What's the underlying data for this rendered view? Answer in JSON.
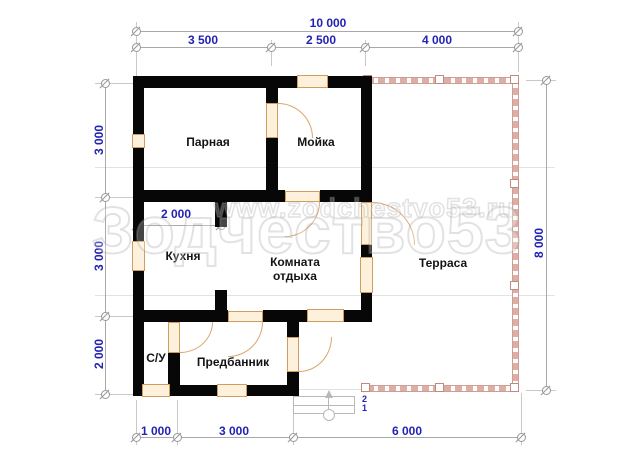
{
  "drawing": {
    "type": "bathhouse floor plan",
    "watermark": {
      "title": "Зодчество53",
      "url": "www.zodchestvo53.ru"
    },
    "rooms": {
      "parnaya": "Парная",
      "moyka": "Мойка",
      "kuhnya": "Кухня",
      "komnata_line1": "Комната",
      "komnata_line2": "отдыха",
      "su": "С/У",
      "predbannik": "Предбанник",
      "terrasa": "Терраса"
    },
    "dims": {
      "top_total": "10 000",
      "top": [
        "3 500",
        "2 500",
        "4 000"
      ],
      "left": [
        "3 000",
        "3 000",
        "2 000"
      ],
      "right_total": "8 000",
      "bottom": [
        "1 000",
        "3 000",
        "6 000"
      ],
      "kitchen": "2 000"
    },
    "stairs": {
      "upper": "2",
      "lower": "1"
    },
    "colors": {
      "walls": "#070707",
      "dimension_text": "#2222b4",
      "dimension_lines": "#a9a9a9",
      "joinery_border": "#cf9d60",
      "joinery_fill": "#fdf1dc",
      "terrace": "#cf9d94"
    }
  }
}
